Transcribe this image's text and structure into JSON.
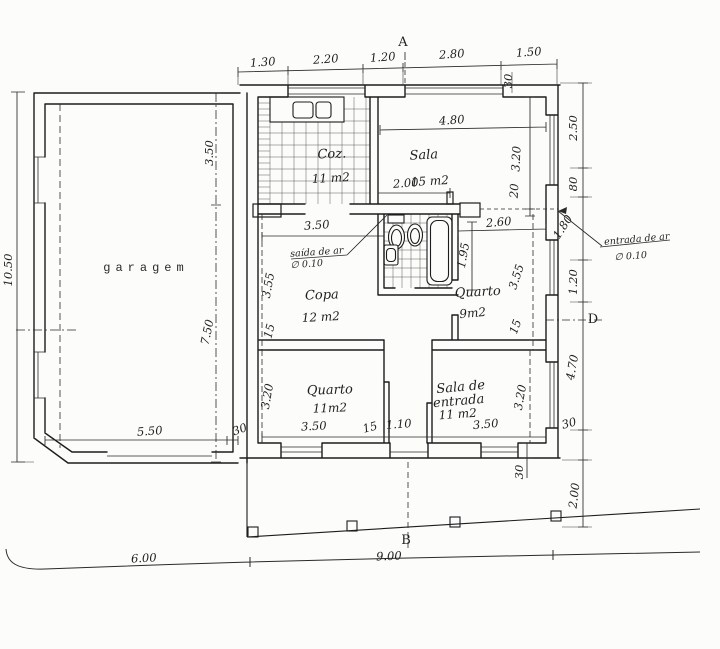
{
  "drawing": {
    "markers": {
      "a": "A",
      "b": "B",
      "d": "D"
    },
    "rooms": {
      "garage": "garagem",
      "kitchen": "Coz.",
      "kitchen_area": "11 m2",
      "living": "Sala",
      "living_area": "15 m2",
      "pantry": "Copa",
      "pantry_area": "12 m2",
      "bedroom_small": "Quarto",
      "bedroom_small_area": "9m2",
      "bedroom": "Quarto",
      "bedroom_area": "11m2",
      "entry_line1": "Sala de",
      "entry_line2": "entrada",
      "entry_area": "11 m2"
    },
    "annotations": {
      "air_outlet_l1": "saída de ar",
      "air_outlet_l2": "∅ 0.10",
      "air_inlet_l1": "entrada de ar",
      "air_inlet_l2": "∅ 0.10"
    },
    "dims": {
      "top": [
        "1.30",
        "2.20",
        "1.20",
        "2.80",
        "1.50"
      ],
      "top_wall": "30",
      "right": [
        "2.50",
        "80",
        "1.80",
        "1.20",
        "4.70",
        "30",
        "2.00"
      ],
      "left": "10.50",
      "bottom_left": "6.00",
      "bottom_right": "9.00",
      "garage_width": "5.50",
      "garage_wall": "30",
      "garage_depth_a": "3.50",
      "garage_depth_b": "7.50",
      "living_width": "4.80",
      "living_pass": "2.00",
      "living_depth": "3.20",
      "living_wall": "20",
      "pantry_width": "3.50",
      "pantry_depth": "3.55",
      "pantry_wall": "15",
      "bed9_width": "2.60",
      "bath_len": "1.95",
      "bed9_depth": "3.55",
      "bed9_wall": "15",
      "bed11_depth": "3.20",
      "bed11_width": "3.50",
      "hall_wall": "15",
      "hall_width": "1.10",
      "entry_width": "3.50",
      "entry_depth": "3.20",
      "entry_wall": "30"
    }
  }
}
